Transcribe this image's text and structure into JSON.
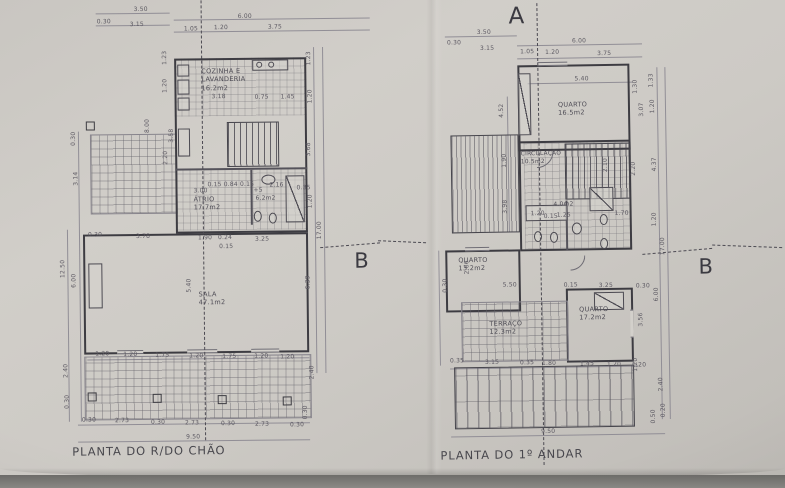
{
  "left_plan": {
    "title": "PLANTA DO R/DO CHÃO",
    "section_label_b": "B",
    "rooms": {
      "cozinha": {
        "name": "COZINHA E",
        "name2": "LAVANDERIA",
        "area": "16.2m2"
      },
      "atrio": {
        "name": "ÁTRIO",
        "area": "17.7m2"
      },
      "is": {
        "area": "6.2m2"
      },
      "sala": {
        "name": "SALA",
        "area": "47.1m2"
      }
    },
    "dims": [
      {
        "t": "3.50",
        "x": 78,
        "y": 6
      },
      {
        "t": "0.30",
        "x": 41,
        "y": 18
      },
      {
        "t": "3.15",
        "x": 74,
        "y": 21
      },
      {
        "t": "6.00",
        "x": 182,
        "y": 14
      },
      {
        "t": "1.05",
        "x": 128,
        "y": 26
      },
      {
        "t": "1.20",
        "x": 158,
        "y": 25
      },
      {
        "t": "3.75",
        "x": 212,
        "y": 25
      },
      {
        "t": "1.23",
        "x": 106,
        "y": 50,
        "v": 1
      },
      {
        "t": "1.20",
        "x": 106,
        "y": 78,
        "v": 1
      },
      {
        "t": "8.00",
        "x": 88,
        "y": 118,
        "v": 1
      },
      {
        "t": "3.58",
        "x": 112,
        "y": 128,
        "v": 1
      },
      {
        "t": "2.20",
        "x": 106,
        "y": 150,
        "v": 1
      },
      {
        "t": "0.30",
        "x": 14,
        "y": 130,
        "v": 1
      },
      {
        "t": "3.14",
        "x": 16,
        "y": 170,
        "v": 1
      },
      {
        "t": "12.50",
        "x": 2,
        "y": 258,
        "v": 1
      },
      {
        "t": "6.00",
        "x": 13,
        "y": 272,
        "v": 1
      },
      {
        "t": "2.40",
        "x": 4,
        "y": 362,
        "v": 1
      },
      {
        "t": "3.18",
        "x": 155,
        "y": 94
      },
      {
        "t": "0.75",
        "x": 198,
        "y": 95
      },
      {
        "t": "1.45",
        "x": 224,
        "y": 95
      },
      {
        "t": "3.00",
        "x": 136,
        "y": 188
      },
      {
        "t": "0.15 0.84 0.15",
        "x": 150,
        "y": 182
      },
      {
        "t": "+5",
        "x": 196,
        "y": 188
      },
      {
        "t": "2.16",
        "x": 212,
        "y": 183
      },
      {
        "t": "0.35",
        "x": 239,
        "y": 186
      },
      {
        "t": "0.30",
        "x": 30,
        "y": 231
      },
      {
        "t": "3.78",
        "x": 78,
        "y": 233
      },
      {
        "t": "1.90",
        "x": 140,
        "y": 235
      },
      {
        "t": "0.24",
        "x": 160,
        "y": 235
      },
      {
        "t": "3.25",
        "x": 197,
        "y": 237
      },
      {
        "t": "0.15",
        "x": 161,
        "y": 244
      },
      {
        "t": "1.23",
        "x": 250,
        "y": 52,
        "v": 1
      },
      {
        "t": "1.20",
        "x": 251,
        "y": 90,
        "v": 1
      },
      {
        "t": "3.68",
        "x": 249,
        "y": 143,
        "v": 1
      },
      {
        "t": "1.20",
        "x": 250,
        "y": 195,
        "v": 1
      },
      {
        "t": "17.00",
        "x": 259,
        "y": 222,
        "v": 1
      },
      {
        "t": "6.39",
        "x": 247,
        "y": 276,
        "v": 1
      },
      {
        "t": "2.40",
        "x": 250,
        "y": 366,
        "v": 1
      },
      {
        "t": "5.40",
        "x": 128,
        "y": 278,
        "v": 1
      },
      {
        "t": "1.20",
        "x": 36,
        "y": 350
      },
      {
        "t": "1.20",
        "x": 64,
        "y": 351
      },
      {
        "t": "1.75",
        "x": 96,
        "y": 352
      },
      {
        "t": "1.20",
        "x": 130,
        "y": 353
      },
      {
        "t": "1.75",
        "x": 163,
        "y": 354
      },
      {
        "t": "1.20",
        "x": 195,
        "y": 354
      },
      {
        "t": "1.20",
        "x": 221,
        "y": 355
      },
      {
        "t": "0.30",
        "x": 5,
        "y": 393,
        "v": 1
      },
      {
        "t": "0.30",
        "x": 22,
        "y": 416
      },
      {
        "t": "2.73",
        "x": 55,
        "y": 417
      },
      {
        "t": "0.30",
        "x": 91,
        "y": 419
      },
      {
        "t": "2.73",
        "x": 125,
        "y": 420
      },
      {
        "t": "0.30",
        "x": 161,
        "y": 421
      },
      {
        "t": "2.73",
        "x": 195,
        "y": 422
      },
      {
        "t": "0.30",
        "x": 230,
        "y": 423
      },
      {
        "t": "9.50",
        "x": 126,
        "y": 434
      },
      {
        "t": "0.30",
        "x": 243,
        "y": 406,
        "v": 1
      }
    ]
  },
  "right_plan": {
    "title": "PLANTA DO 1º ANDAR",
    "section_label_a": "A",
    "section_label_b": "B",
    "rooms": {
      "quarto1": {
        "name": "QUARTO",
        "area": "16.5m2"
      },
      "circulacao": {
        "name": "CIRCULAÇÃO",
        "area": "10.5m2"
      },
      "is": {
        "area": "4.0m2"
      },
      "quarto2": {
        "name": "QUARTO",
        "area": "13.2m2"
      },
      "terraco": {
        "name": "TERRAÇO",
        "area": "12.3m2"
      },
      "quarto3": {
        "name": "QUARTO",
        "area": "17.2m2"
      }
    },
    "dims": [
      {
        "t": "3.50",
        "x": 50,
        "y": 28
      },
      {
        "t": "0.30",
        "x": 20,
        "y": 38
      },
      {
        "t": "3.15",
        "x": 53,
        "y": 44
      },
      {
        "t": "6.00",
        "x": 145,
        "y": 38
      },
      {
        "t": "1.05",
        "x": 93,
        "y": 48
      },
      {
        "t": "1.20",
        "x": 118,
        "y": 49
      },
      {
        "t": "3.75",
        "x": 170,
        "y": 51
      },
      {
        "t": "5.40",
        "x": 147,
        "y": 76
      },
      {
        "t": "1.33",
        "x": 221,
        "y": 74,
        "v": 1
      },
      {
        "t": "1.20",
        "x": 222,
        "y": 100,
        "v": 1
      },
      {
        "t": "3.07",
        "x": 211,
        "y": 103,
        "v": 1
      },
      {
        "t": "1.30",
        "x": 205,
        "y": 80,
        "v": 1
      },
      {
        "t": "4.52",
        "x": 71,
        "y": 102,
        "v": 1
      },
      {
        "t": "1.90",
        "x": 73,
        "y": 152,
        "v": 1
      },
      {
        "t": "3.98",
        "x": 73,
        "y": 198,
        "v": 1
      },
      {
        "t": "2.10",
        "x": 174,
        "y": 158,
        "v": 1
      },
      {
        "t": "4.37",
        "x": 223,
        "y": 158,
        "v": 1
      },
      {
        "t": "2.20",
        "x": 202,
        "y": 162,
        "v": 1
      },
      {
        "t": "1.20",
        "x": 222,
        "y": 213,
        "v": 1
      },
      {
        "t": "17.00",
        "x": 230,
        "y": 238,
        "v": 1
      },
      {
        "t": "1.20",
        "x": 101,
        "y": 210
      },
      {
        "t": "0.15",
        "x": 114,
        "y": 213
      },
      {
        "t": "1.25",
        "x": 127,
        "y": 212
      },
      {
        "t": "1.70",
        "x": 185,
        "y": 211
      },
      {
        "t": "2.66",
        "x": 34,
        "y": 258,
        "v": 1
      },
      {
        "t": "0.30",
        "x": 12,
        "y": 276,
        "v": 1
      },
      {
        "t": "5.50",
        "x": 72,
        "y": 281
      },
      {
        "t": "0.15",
        "x": 133,
        "y": 282
      },
      {
        "t": "3.25",
        "x": 168,
        "y": 283
      },
      {
        "t": "0.30",
        "x": 205,
        "y": 284
      },
      {
        "t": "6.00",
        "x": 223,
        "y": 288,
        "v": 1
      },
      {
        "t": "3.56",
        "x": 207,
        "y": 313,
        "v": 1
      },
      {
        "t": "1.20",
        "x": 201,
        "y": 358,
        "v": 1
      },
      {
        "t": "0.35",
        "x": 18,
        "y": 356
      },
      {
        "t": "3.15",
        "x": 53,
        "y": 358
      },
      {
        "t": "0.35",
        "x": 88,
        "y": 359
      },
      {
        "t": "1.80",
        "x": 110,
        "y": 360
      },
      {
        "t": "1.45",
        "x": 148,
        "y": 361
      },
      {
        "t": "1.20",
        "x": 175,
        "y": 362
      },
      {
        "t": "1.20",
        "x": 200,
        "y": 363
      },
      {
        "t": "2.40",
        "x": 226,
        "y": 378,
        "v": 1
      },
      {
        "t": "0.50",
        "x": 218,
        "y": 410,
        "v": 1
      },
      {
        "t": "0.20",
        "x": 228,
        "y": 404,
        "v": 1
      },
      {
        "t": "9.50",
        "x": 108,
        "y": 428
      }
    ]
  }
}
